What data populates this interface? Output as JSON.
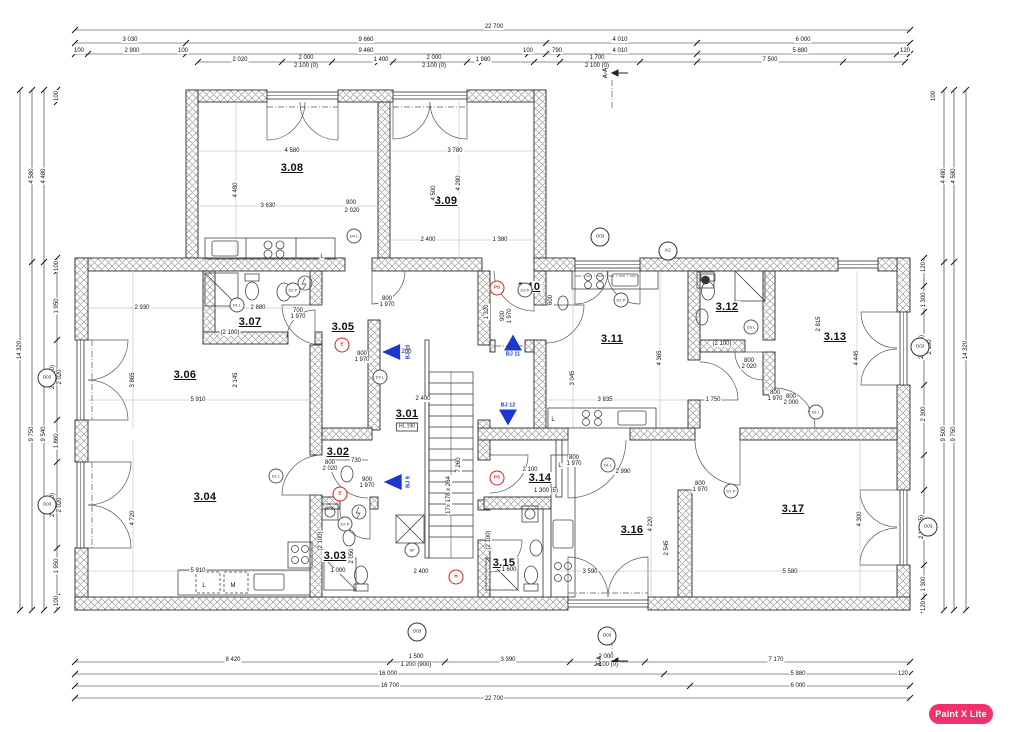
{
  "watermark": {
    "label": "Paint X Lite",
    "bg": "#f2306b"
  },
  "colors": {
    "wall_stroke": "#2e2e2e",
    "hatch": "#9a9a9a",
    "accent_blue": "#1c39cf",
    "accent_red": "#cf2424",
    "line": "#444444"
  },
  "rooms": [
    {
      "id": "3.01",
      "x": 407,
      "y": 414
    },
    {
      "id": "3.02",
      "x": 338,
      "y": 452
    },
    {
      "id": "3.03",
      "x": 335,
      "y": 556
    },
    {
      "id": "3.04",
      "x": 205,
      "y": 497
    },
    {
      "id": "3.05",
      "x": 343,
      "y": 327
    },
    {
      "id": "3.06",
      "x": 185,
      "y": 375
    },
    {
      "id": "3.07",
      "x": 250,
      "y": 322
    },
    {
      "id": "3.08",
      "x": 292,
      "y": 168
    },
    {
      "id": "3.09",
      "x": 446,
      "y": 201
    },
    {
      "id": "3.10",
      "x": 529,
      "y": 287
    },
    {
      "id": "3.11",
      "x": 612,
      "y": 339
    },
    {
      "id": "3.12",
      "x": 727,
      "y": 307
    },
    {
      "id": "3.13",
      "x": 835,
      "y": 337
    },
    {
      "id": "3.14",
      "x": 540,
      "y": 478
    },
    {
      "id": "3.15",
      "x": 504,
      "y": 563
    },
    {
      "id": "3.16",
      "x": 632,
      "y": 530
    },
    {
      "id": "3.17",
      "x": 793,
      "y": 509
    }
  ],
  "stair_note": {
    "t": "HL 190",
    "x": 407,
    "y": 427
  },
  "arrows": [
    {
      "label": "BJ 10",
      "x": 399,
      "y": 352,
      "dir": "left"
    },
    {
      "label": "BJ 9",
      "x": 399,
      "y": 482,
      "dir": "left"
    },
    {
      "label": "BJ 11",
      "x": 513,
      "y": 346,
      "dir": "up"
    },
    {
      "label": "BJ 12",
      "x": 508,
      "y": 414,
      "dir": "down"
    }
  ],
  "red_marks": [
    {
      "t": "PS",
      "x": 497,
      "y": 288
    },
    {
      "t": "PS",
      "x": 497,
      "y": 478
    },
    {
      "t": "E",
      "x": 342,
      "y": 345
    },
    {
      "t": "E",
      "x": 340,
      "y": 494
    },
    {
      "t": "H",
      "x": 456,
      "y": 577
    }
  ],
  "door_tags": [
    {
      "t": "D4 L",
      "x": 354,
      "y": 236
    },
    {
      "t": "D1 L",
      "x": 237,
      "y": 305
    },
    {
      "t": "D2 P",
      "x": 293,
      "y": 290
    },
    {
      "t": "D1 P",
      "x": 621,
      "y": 300
    },
    {
      "t": "D3 L",
      "x": 751,
      "y": 327
    },
    {
      "t": "D1 L",
      "x": 816,
      "y": 412
    },
    {
      "t": "D1 L",
      "x": 276,
      "y": 476
    },
    {
      "t": "D3 P",
      "x": 525,
      "y": 290
    },
    {
      "t": "D1 P",
      "x": 731,
      "y": 491
    },
    {
      "t": "D1 L",
      "x": 608,
      "y": 465
    },
    {
      "t": "D2 L",
      "x": 380,
      "y": 377
    },
    {
      "t": "D2 P",
      "x": 345,
      "y": 524
    },
    {
      "t": "SP",
      "x": 412,
      "y": 550
    }
  ],
  "window_tags": [
    {
      "t": "O03",
      "x": 600,
      "y": 237
    },
    {
      "t": "K2",
      "x": 668,
      "y": 251
    },
    {
      "t": "O03",
      "x": 920,
      "y": 347
    },
    {
      "t": "O03",
      "x": 928,
      "y": 527
    },
    {
      "t": "O03",
      "x": 607,
      "y": 636
    },
    {
      "t": "O03",
      "x": 417,
      "y": 632
    },
    {
      "t": "O03",
      "x": 47,
      "y": 378
    },
    {
      "t": "O03",
      "x": 47,
      "y": 505
    }
  ],
  "section_marks": [
    {
      "label": "A-A",
      "x": 606,
      "y": 73,
      "ax": 618,
      "ay": 73
    },
    {
      "label": "A-A",
      "x": 600,
      "y": 661,
      "ax": 612,
      "ay": 661
    }
  ],
  "dims": [
    {
      "t": "22 700",
      "x": 494,
      "y": 27
    },
    {
      "t": "3 030",
      "x": 130,
      "y": 40
    },
    {
      "t": "9 660",
      "x": 366,
      "y": 40
    },
    {
      "t": "4 010",
      "x": 620,
      "y": 40
    },
    {
      "t": "6 000",
      "x": 803,
      "y": 40
    },
    {
      "t": "100",
      "x": 79,
      "y": 51
    },
    {
      "t": "2 900",
      "x": 132,
      "y": 51
    },
    {
      "t": "100",
      "x": 183,
      "y": 51
    },
    {
      "t": "9 460",
      "x": 366,
      "y": 51
    },
    {
      "t": "100",
      "x": 528,
      "y": 51
    },
    {
      "t": "790",
      "x": 557,
      "y": 51
    },
    {
      "t": "4 010",
      "x": 620,
      "y": 51
    },
    {
      "t": "5 880",
      "x": 800,
      "y": 51
    },
    {
      "t": "120",
      "x": 905,
      "y": 51
    },
    {
      "t": "2 020",
      "x": 240,
      "y": 60
    },
    {
      "t": "2 000",
      "x": 306,
      "y": 58
    },
    {
      "t": "2 100 (0)",
      "x": 306,
      "y": 66
    },
    {
      "t": "1 400",
      "x": 381,
      "y": 60
    },
    {
      "t": "2 000",
      "x": 434,
      "y": 58
    },
    {
      "t": "2 100 (0)",
      "x": 434,
      "y": 66
    },
    {
      "t": "1 980",
      "x": 483,
      "y": 60
    },
    {
      "t": "1 700",
      "x": 597,
      "y": 58
    },
    {
      "t": "2 100 (0)",
      "x": 597,
      "y": 66
    },
    {
      "t": "7 500",
      "x": 770,
      "y": 60
    },
    {
      "t": "8 420",
      "x": 233,
      "y": 660
    },
    {
      "t": "1 500",
      "x": 416,
      "y": 657
    },
    {
      "t": "1 200 (900)",
      "x": 416,
      "y": 665
    },
    {
      "t": "3 390",
      "x": 508,
      "y": 660
    },
    {
      "t": "2 000",
      "x": 606,
      "y": 657
    },
    {
      "t": "2 100 (0)",
      "x": 606,
      "y": 665
    },
    {
      "t": "7 170",
      "x": 776,
      "y": 660
    },
    {
      "t": "16 000",
      "x": 388,
      "y": 674
    },
    {
      "t": "5 880",
      "x": 798,
      "y": 674
    },
    {
      "t": "120",
      "x": 903,
      "y": 674
    },
    {
      "t": "16 700",
      "x": 390,
      "y": 686
    },
    {
      "t": "6 000",
      "x": 798,
      "y": 686
    },
    {
      "t": "22 700",
      "x": 494,
      "y": 699
    },
    {
      "t": "14 320",
      "x": 20,
      "y": 350,
      "v": true
    },
    {
      "t": "4 580",
      "x": 32,
      "y": 176,
      "v": true
    },
    {
      "t": "4 480",
      "x": 44,
      "y": 176,
      "v": true
    },
    {
      "t": "9 750",
      "x": 32,
      "y": 434,
      "v": true
    },
    {
      "t": "9 540",
      "x": 44,
      "y": 434,
      "v": true
    },
    {
      "t": "100",
      "x": 57,
      "y": 96,
      "v": true
    },
    {
      "t": "100",
      "x": 57,
      "y": 266,
      "v": true
    },
    {
      "t": "1 950",
      "x": 57,
      "y": 306,
      "v": true
    },
    {
      "t": "2 020",
      "x": 60,
      "y": 377,
      "v": true
    },
    {
      "t": "2 100 (0)",
      "x": 53,
      "y": 377,
      "v": true
    },
    {
      "t": "1 860",
      "x": 57,
      "y": 441,
      "v": true
    },
    {
      "t": "2 020",
      "x": 60,
      "y": 505,
      "v": true
    },
    {
      "t": "2 100 (0)",
      "x": 53,
      "y": 505,
      "v": true
    },
    {
      "t": "1 950",
      "x": 57,
      "y": 566,
      "v": true
    },
    {
      "t": "100",
      "x": 57,
      "y": 601,
      "v": true
    },
    {
      "t": "14 320",
      "x": 966,
      "y": 350,
      "v": true
    },
    {
      "t": "4 580",
      "x": 954,
      "y": 176,
      "v": true
    },
    {
      "t": "4 480",
      "x": 944,
      "y": 176,
      "v": true
    },
    {
      "t": "9 750",
      "x": 954,
      "y": 434,
      "v": true
    },
    {
      "t": "9 500",
      "x": 944,
      "y": 434,
      "v": true
    },
    {
      "t": "100",
      "x": 934,
      "y": 96,
      "v": true
    },
    {
      "t": "120",
      "x": 924,
      "y": 267,
      "v": true
    },
    {
      "t": "1 300",
      "x": 924,
      "y": 300,
      "v": true
    },
    {
      "t": "2 100",
      "x": 930,
      "y": 347,
      "v": true
    },
    {
      "t": "2 100 (5)",
      "x": 922,
      "y": 347,
      "v": true
    },
    {
      "t": "2 300",
      "x": 924,
      "y": 414,
      "v": true
    },
    {
      "t": "2 100",
      "x": 930,
      "y": 527,
      "v": true
    },
    {
      "t": "2 100 (5)",
      "x": 922,
      "y": 527,
      "v": true
    },
    {
      "t": "1 300",
      "x": 924,
      "y": 584,
      "v": true
    },
    {
      "t": "120",
      "x": 924,
      "y": 606,
      "v": true
    },
    {
      "t": "4 580",
      "x": 292,
      "y": 151
    },
    {
      "t": "4 480",
      "x": 236,
      "y": 190,
      "v": true
    },
    {
      "t": "3 630",
      "x": 268,
      "y": 206
    },
    {
      "t": "900",
      "x": 351,
      "y": 203
    },
    {
      "t": "2 020",
      "x": 352,
      "y": 211
    },
    {
      "t": "3 780",
      "x": 455,
      "y": 151
    },
    {
      "t": "4 500",
      "x": 434,
      "y": 193,
      "v": true
    },
    {
      "t": "4 280",
      "x": 459,
      "y": 183,
      "v": true
    },
    {
      "t": "2 400",
      "x": 428,
      "y": 240
    },
    {
      "t": "1 380",
      "x": 500,
      "y": 240
    },
    {
      "t": "2 930",
      "x": 142,
      "y": 308
    },
    {
      "t": "3 865",
      "x": 133,
      "y": 380,
      "v": true
    },
    {
      "t": "2 145",
      "x": 236,
      "y": 380,
      "v": true
    },
    {
      "t": "5 910",
      "x": 198,
      "y": 400
    },
    {
      "t": "2 880",
      "x": 258,
      "y": 308
    },
    {
      "t": "(2 100)",
      "x": 230,
      "y": 333
    },
    {
      "t": "700",
      "x": 298,
      "y": 311
    },
    {
      "t": "1 970",
      "x": 298,
      "y": 317
    },
    {
      "t": "800",
      "x": 387,
      "y": 299
    },
    {
      "t": "1 970",
      "x": 387,
      "y": 305
    },
    {
      "t": "900",
      "x": 362,
      "y": 354
    },
    {
      "t": "1 970",
      "x": 362,
      "y": 360
    },
    {
      "t": "1 200",
      "x": 404,
      "y": 352
    },
    {
      "t": "2 400",
      "x": 423,
      "y": 399
    },
    {
      "t": "17x 178 x 264",
      "x": 449,
      "y": 495,
      "v": true
    },
    {
      "t": "7 260",
      "x": 459,
      "y": 465,
      "v": true
    },
    {
      "t": "2 400",
      "x": 421,
      "y": 572
    },
    {
      "t": "1 320",
      "x": 487,
      "y": 312,
      "v": true
    },
    {
      "t": "900",
      "x": 503,
      "y": 316,
      "v": true
    },
    {
      "t": "1 970",
      "x": 510,
      "y": 316,
      "v": true
    },
    {
      "t": "3 835",
      "x": 605,
      "y": 400
    },
    {
      "t": "4 365",
      "x": 660,
      "y": 358,
      "v": true
    },
    {
      "t": "3 045",
      "x": 573,
      "y": 378,
      "v": true
    },
    {
      "t": "600",
      "x": 551,
      "y": 300,
      "v": true
    },
    {
      "t": "(2 100)",
      "x": 722,
      "y": 344
    },
    {
      "t": "1 750",
      "x": 713,
      "y": 400
    },
    {
      "t": "800",
      "x": 791,
      "y": 397
    },
    {
      "t": "2 000",
      "x": 791,
      "y": 403
    },
    {
      "t": "800",
      "x": 749,
      "y": 361
    },
    {
      "t": "2 020",
      "x": 749,
      "y": 367
    },
    {
      "t": "2 815",
      "x": 819,
      "y": 324,
      "v": true
    },
    {
      "t": "4 445",
      "x": 857,
      "y": 358,
      "v": true
    },
    {
      "t": "800",
      "x": 775,
      "y": 393
    },
    {
      "t": "1 970",
      "x": 775,
      "y": 399
    },
    {
      "t": "2 000",
      "x": 815,
      "y": 411
    },
    {
      "t": "2 100",
      "x": 530,
      "y": 470
    },
    {
      "t": "1 300 (5)",
      "x": 546,
      "y": 491
    },
    {
      "t": "800",
      "x": 574,
      "y": 458
    },
    {
      "t": "1 970",
      "x": 574,
      "y": 464
    },
    {
      "t": "1 600",
      "x": 509,
      "y": 570
    },
    {
      "t": "(2 100)",
      "x": 489,
      "y": 540,
      "v": true
    },
    {
      "t": "2 990",
      "x": 623,
      "y": 472
    },
    {
      "t": "4 220",
      "x": 651,
      "y": 524,
      "v": true
    },
    {
      "t": "2 545",
      "x": 667,
      "y": 548,
      "v": true
    },
    {
      "t": "3 590",
      "x": 590,
      "y": 572
    },
    {
      "t": "5 580",
      "x": 790,
      "y": 572
    },
    {
      "t": "4 300",
      "x": 860,
      "y": 519,
      "v": true
    },
    {
      "t": "800",
      "x": 700,
      "y": 484
    },
    {
      "t": "1 970",
      "x": 700,
      "y": 490
    },
    {
      "t": "4 720",
      "x": 133,
      "y": 518,
      "v": true
    },
    {
      "t": "5 910",
      "x": 198,
      "y": 571
    },
    {
      "t": "800",
      "x": 330,
      "y": 463
    },
    {
      "t": "2 020",
      "x": 330,
      "y": 469
    },
    {
      "t": "730",
      "x": 356,
      "y": 461
    },
    {
      "t": "900",
      "x": 367,
      "y": 480
    },
    {
      "t": "1 970",
      "x": 367,
      "y": 486
    },
    {
      "t": "(2 100)",
      "x": 321,
      "y": 541,
      "v": true
    },
    {
      "t": "1 000",
      "x": 338,
      "y": 571
    },
    {
      "t": "2 050",
      "x": 352,
      "y": 556,
      "v": true
    },
    {
      "t": "L",
      "x": 322,
      "y": 257
    },
    {
      "t": "L",
      "x": 204,
      "y": 586
    },
    {
      "t": "M",
      "x": 233,
      "y": 586
    },
    {
      "t": "L",
      "x": 553,
      "y": 420
    },
    {
      "t": "L",
      "x": 560,
      "y": 466
    }
  ]
}
